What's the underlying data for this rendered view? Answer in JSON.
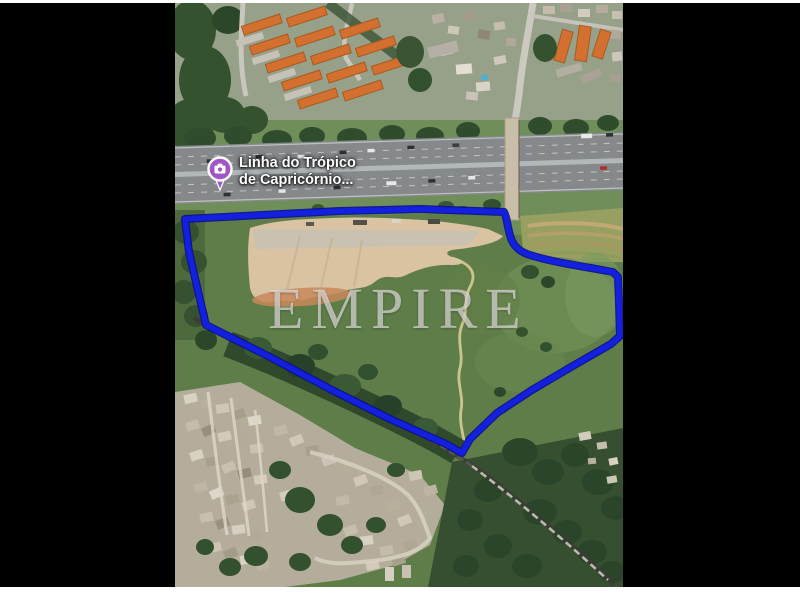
{
  "page": {
    "background_color": "#ffffff",
    "letterbox_color": "#000000"
  },
  "map": {
    "type": "satellite-photo",
    "watermark": "EMPIRE",
    "poi_label": {
      "line1": "Linha do Trópico",
      "line2": "de Capricórnio...",
      "icon": "camera-photo-pin-icon",
      "pin_color": "#a155c7",
      "text_color": "#ffffff"
    },
    "boundary": {
      "color": "#1420e0",
      "shape": "property-outline-polygon"
    }
  }
}
